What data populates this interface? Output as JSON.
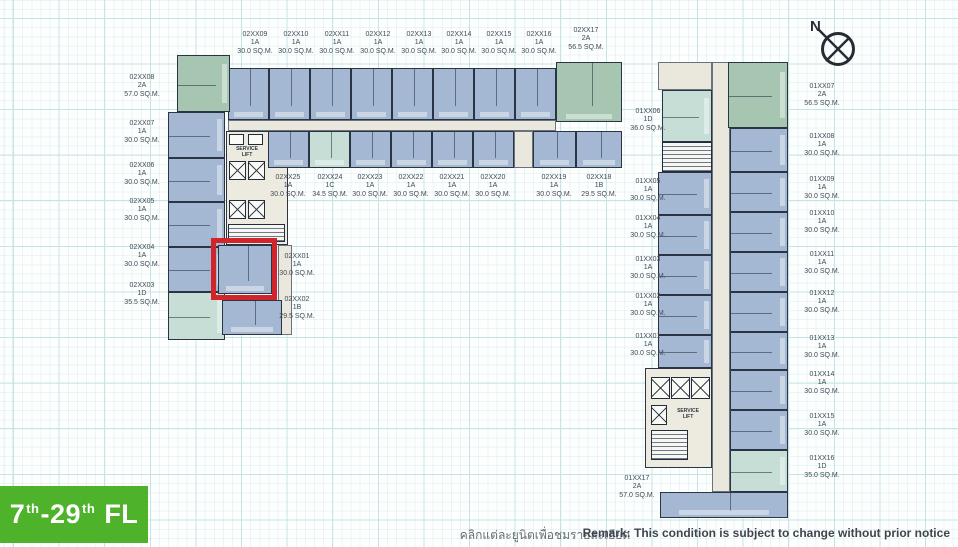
{
  "page": {
    "compass_label": "N",
    "thai_note": "คลิกแต่ละยูนิตเพื่อชมรายละเอียดและผังห้อง",
    "remark": "Remark: This condition is subject to change without prior notice",
    "floor_badge": {
      "p1": "7",
      "s1": "th",
      "p2": "-29",
      "s2": "th",
      "p3": " FL"
    }
  },
  "colors": {
    "unit_blue": "#a5b8d3",
    "unit_green": "#a6c6b2",
    "unit_light_green": "#c7ded7",
    "corridor": "#eae8dc",
    "highlight_red": "#d2252b",
    "badge_green": "#4eb22a",
    "grid_line": "#c6e4e6"
  },
  "core": {
    "service_lift": "SERVICE\nLIFT"
  },
  "highlight": {
    "unit": "02XX01"
  },
  "buildings": {
    "building_02": {
      "top_row": [
        {
          "id": "02XX09",
          "type": "1A",
          "area": "30.0 SQ.M."
        },
        {
          "id": "02XX10",
          "type": "1A",
          "area": "30.0 SQ.M."
        },
        {
          "id": "02XX11",
          "type": "1A",
          "area": "30.0 SQ.M."
        },
        {
          "id": "02XX12",
          "type": "1A",
          "area": "30.0 SQ.M."
        },
        {
          "id": "02XX13",
          "type": "1A",
          "area": "30.0 SQ.M."
        },
        {
          "id": "02XX14",
          "type": "1A",
          "area": "30.0 SQ.M."
        },
        {
          "id": "02XX15",
          "type": "1A",
          "area": "30.0 SQ.M."
        },
        {
          "id": "02XX16",
          "type": "1A",
          "area": "30.0 SQ.M."
        },
        {
          "id": "02XX17",
          "type": "2A",
          "area": "56.5 SQ.M."
        }
      ],
      "left_col": [
        {
          "id": "02XX08",
          "type": "2A",
          "area": "57.0 SQ.M."
        },
        {
          "id": "02XX07",
          "type": "1A",
          "area": "30.0 SQ.M."
        },
        {
          "id": "02XX06",
          "type": "1A",
          "area": "30.0 SQ.M."
        },
        {
          "id": "02XX05",
          "type": "1A",
          "area": "30.0 SQ.M."
        },
        {
          "id": "02XX04",
          "type": "1A",
          "area": "30.0 SQ.M."
        },
        {
          "id": "02XX03",
          "type": "1D",
          "area": "35.5 SQ.M."
        }
      ],
      "mid_row": [
        {
          "id": "02XX25",
          "type": "1A",
          "area": "30.0 SQ.M."
        },
        {
          "id": "02XX24",
          "type": "1C",
          "area": "34.5 SQ.M."
        },
        {
          "id": "02XX23",
          "type": "1A",
          "area": "30.0 SQ.M."
        },
        {
          "id": "02XX22",
          "type": "1A",
          "area": "30.0 SQ.M."
        },
        {
          "id": "02XX21",
          "type": "1A",
          "area": "30.0 SQ.M."
        },
        {
          "id": "02XX20",
          "type": "1A",
          "area": "30.0 SQ.M."
        },
        {
          "id": "02XX19",
          "type": "1A",
          "area": "30.0 SQ.M."
        },
        {
          "id": "02XX18",
          "type": "1B",
          "area": "29.5 SQ.M."
        }
      ],
      "south_units": [
        {
          "id": "02XX01",
          "type": "1A",
          "area": "30.0 SQ.M."
        },
        {
          "id": "02XX02",
          "type": "1B",
          "area": "29.5 SQ.M."
        }
      ]
    },
    "building_01": {
      "west_col": [
        {
          "id": "01XX06",
          "type": "1D",
          "area": "36.0 SQ.M."
        },
        {
          "id": "01XX05",
          "type": "1A",
          "area": "30.0 SQ.M."
        },
        {
          "id": "01XX04",
          "type": "1A",
          "area": "30.0 SQ.M."
        },
        {
          "id": "01XX03",
          "type": "1A",
          "area": "30.0 SQ.M."
        },
        {
          "id": "01XX02",
          "type": "1A",
          "area": "30.0 SQ.M."
        },
        {
          "id": "01XX01",
          "type": "1A",
          "area": "30.0 SQ.M."
        },
        {
          "id": "01XX17",
          "type": "2A",
          "area": "57.0 SQ.M."
        }
      ],
      "east_col": [
        {
          "id": "01XX07",
          "type": "2A",
          "area": "56.5 SQ.M."
        },
        {
          "id": "01XX08",
          "type": "1A",
          "area": "30.0 SQ.M."
        },
        {
          "id": "01XX09",
          "type": "1A",
          "area": "30.0 SQ.M."
        },
        {
          "id": "01XX10",
          "type": "1A",
          "area": "30.0 SQ.M."
        },
        {
          "id": "01XX11",
          "type": "1A",
          "area": "30.0 SQ.M."
        },
        {
          "id": "01XX12",
          "type": "1A",
          "area": "30.0 SQ.M."
        },
        {
          "id": "01XX13",
          "type": "1A",
          "area": "30.0 SQ.M."
        },
        {
          "id": "01XX14",
          "type": "1A",
          "area": "30.0 SQ.M."
        },
        {
          "id": "01XX15",
          "type": "1A",
          "area": "30.0 SQ.M."
        },
        {
          "id": "01XX16",
          "type": "1D",
          "area": "35.0 SQ.M."
        }
      ]
    }
  }
}
